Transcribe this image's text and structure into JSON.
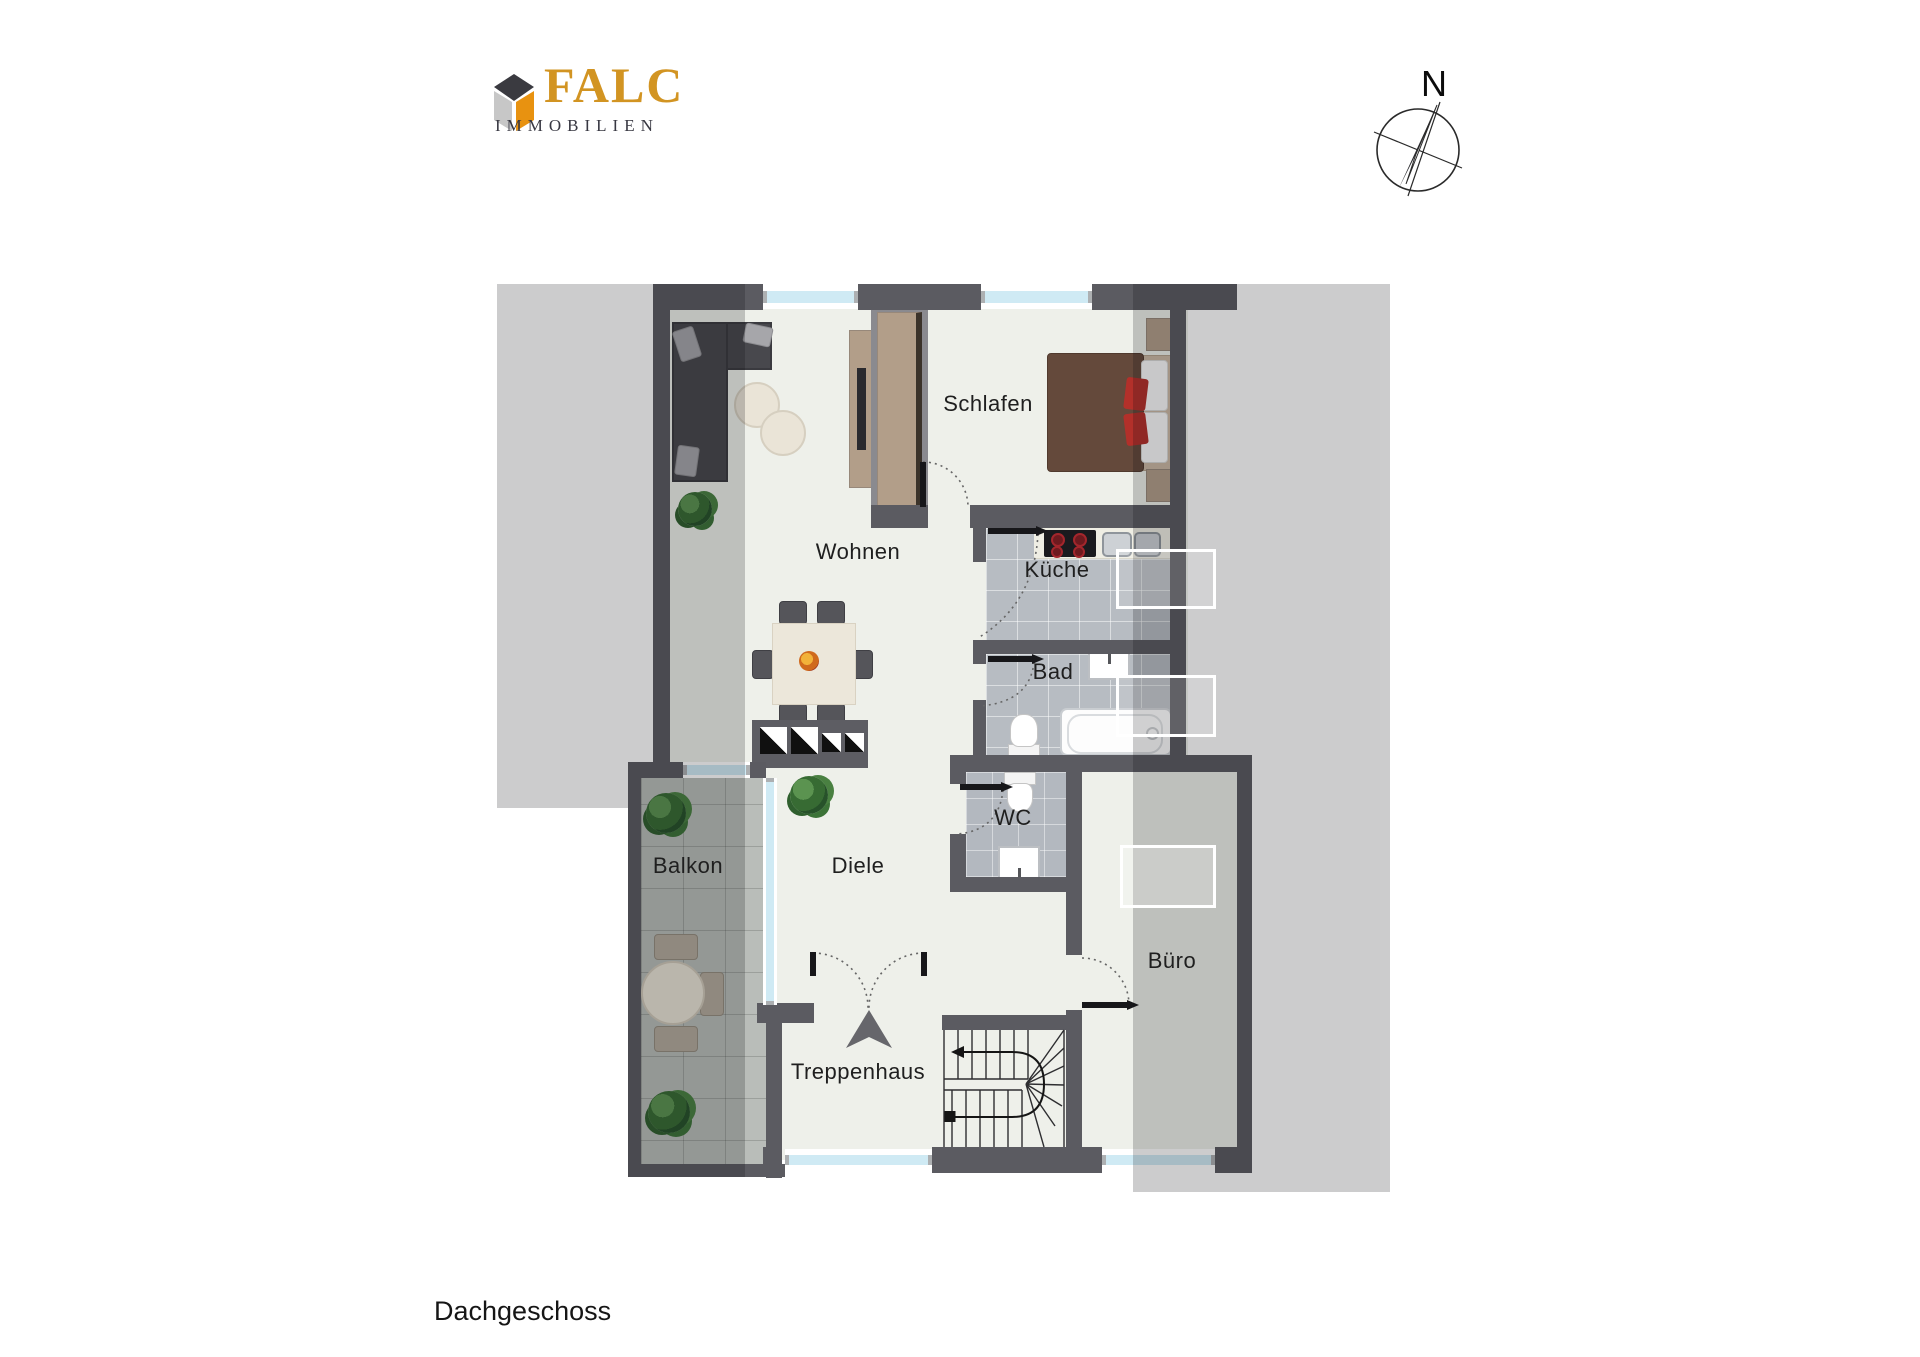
{
  "title": {
    "floor_label": "Dachgeschoss"
  },
  "brand": {
    "name": "FALC",
    "subtitle": "IMMOBILIEN",
    "logo_icon": "falc-house-logo-icon",
    "accent_color": "#d29422",
    "subtitle_color": "#383842"
  },
  "compass": {
    "icon": "compass-rose-icon",
    "north_label": "N"
  },
  "rooms": [
    {
      "id": "wohnen",
      "label": "Wohnen"
    },
    {
      "id": "schlafen",
      "label": "Schlafen"
    },
    {
      "id": "kueche",
      "label": "Küche"
    },
    {
      "id": "bad",
      "label": "Bad"
    },
    {
      "id": "wc",
      "label": "WC"
    },
    {
      "id": "diele",
      "label": "Diele"
    },
    {
      "id": "balkon",
      "label": "Balkon"
    },
    {
      "id": "buero",
      "label": "Büro"
    },
    {
      "id": "treppenhaus",
      "label": "Treppenhaus"
    }
  ],
  "colors": {
    "wall": "#5b5b61",
    "floor": "#eef0ea",
    "tile": "#b7bcc2",
    "balcony_tile": "#b9bdb9",
    "window_glass": "#cfeaf4",
    "roof_overlay": "rgba(15,15,18,0.21)",
    "furniture_wood": "#b29e89",
    "accent_red": "#b3302a",
    "bed_blanket": "#64493b"
  }
}
